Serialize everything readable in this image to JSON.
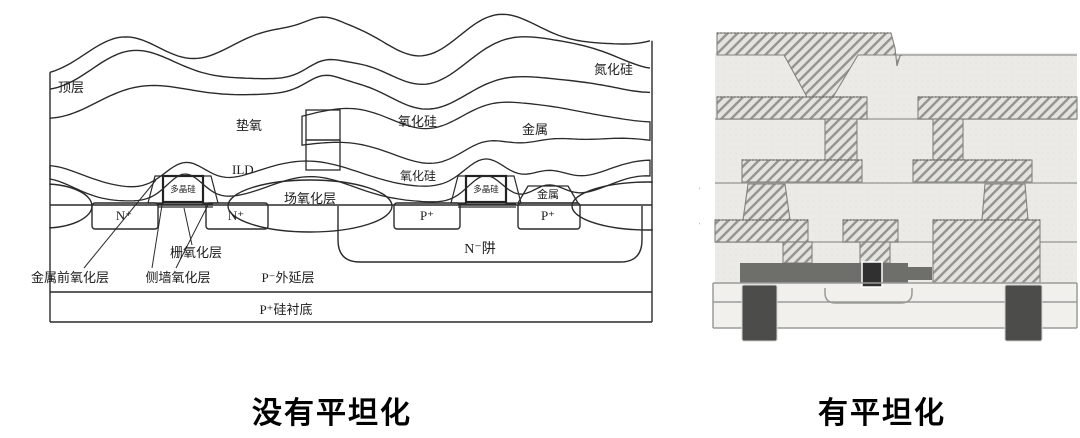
{
  "left_diagram": {
    "caption": "没有平坦化",
    "labels": {
      "top_layer": "顶层",
      "pad_oxide": "垫氧",
      "silicon_nitride": "氮化硅",
      "silicon_oxide_upper": "氧化硅",
      "metal_upper": "金属",
      "ild": "ILD",
      "silicon_oxide_mid": "氧化硅",
      "poly_gate_left": "多晶硅",
      "poly_gate_right": "多晶硅",
      "metal_contact": "金属",
      "field_oxide": "场氧化层",
      "n_plus_left": "N⁺",
      "n_plus_right": "N⁺",
      "p_plus_left": "P⁺",
      "p_plus_right": "P⁺",
      "n_well": "N⁻阱",
      "gate_oxide": "栅氧化层",
      "pre_metal_oxide": "金属前氧化层",
      "sidewall_oxide": "侧墙氧化层",
      "p_epi": "P⁻外延层",
      "p_substrate": "P⁺硅衬底"
    }
  },
  "right_diagram": {
    "caption": "有平坦化"
  },
  "colors": {
    "ink": "#2a2a2a",
    "hatch_gray": "#94948f",
    "dielectric_gray": "#ebeae6",
    "substrate_gray": "#f1f0ec",
    "trench_dark": "#4c4c4a",
    "gate_bar_gray": "#6e6e6b",
    "gate_dark": "#303030"
  }
}
